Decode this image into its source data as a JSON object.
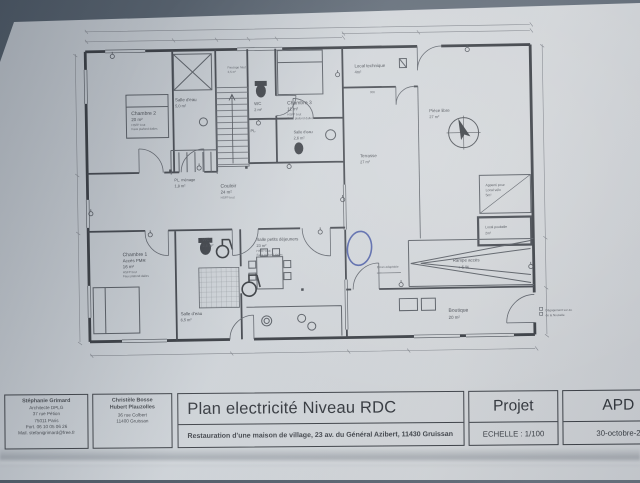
{
  "title_block": {
    "architect1": {
      "lines": [
        "Stéphanie Grimard",
        "Architecte DPLG",
        "37 rue Pétion",
        "75011 Paris",
        "Port. 06 10 05 06 26",
        "Mail. stefanigrimard@free.fr"
      ]
    },
    "architect2": {
      "lines": [
        "Christèle Bosse",
        "Hubert Plauzolles",
        "36 rue Colbert",
        "11400 Gruissan"
      ]
    },
    "title": "Plan electricité Niveau RDC",
    "subtitle": "Restauration d'une maison de village, 23 av. du Général Azibert, 11430 Gruissan",
    "phase_label": "Projet",
    "phase_value": "APD",
    "scale": "ECHELLE : 1/100",
    "date": "30-octobre-2"
  },
  "plan": {
    "rooms": {
      "chambre2": {
        "name": "Chambre 2",
        "area": "20 m²",
        "sub1": "HSFP brut",
        "sub2": "Faux plafond dalles"
      },
      "salle_eau_et2": {
        "name": "Salle d'eau",
        "area": "5,0 m²"
      },
      "wc_haut": {
        "name": "WC",
        "area": "2 m²"
      },
      "passage": {
        "name": "Passage haut",
        "area": "2,5 m²"
      },
      "chambre3": {
        "name": "Chambre 3",
        "area": "11 m²",
        "sub1": "HSFP brut",
        "sub2": "Faux plafond dalles"
      },
      "salle_eau_et3": {
        "name": "Salle d'eau",
        "area": "2,6 m²"
      },
      "pl": {
        "name": "PL."
      },
      "pl_menage": {
        "name": "PL. ménage",
        "area": "1,8 m²"
      },
      "couloir": {
        "name": "Couloir",
        "area": "24 m²",
        "sub1": "HSFP brut"
      },
      "chambre1": {
        "name": "Chambre 1",
        "sub0": "Accès PMR",
        "area": "16 m²",
        "sub1": "HSFP brut",
        "sub2": "Faux plafond dalles"
      },
      "wc_bas": {
        "name": "WC",
        "area": "2,6 m²"
      },
      "salle_eau_et1": {
        "name": "Salle d'eau",
        "area": "6,5 m²"
      },
      "petits_dejeuners": {
        "name": "Salle petits déjeuners",
        "area": "23 m²",
        "sub1": "HSFP brut",
        "sub2": "Faux plafond dalles"
      },
      "terrasse": {
        "name": "Terrasse",
        "area": "27 m²"
      },
      "piece": {
        "name": "Pièce libre",
        "area": "27 m²"
      },
      "local_technique": {
        "name": "Local technique",
        "area": "4m²"
      },
      "local_velo": {
        "line1": "Appenti pour",
        "line2": "Local vélo",
        "area": "5m²"
      },
      "local_poubelle": {
        "name": "Local poubelle",
        "area": "2m²"
      },
      "rampe": {
        "name": "Rampe accès",
        "area": "+ 5 %"
      },
      "boutique": {
        "name": "Boutique",
        "area": "20 m²"
      },
      "ecran": {
        "name": "Ecran adaptable"
      },
      "degagement": {
        "line1": "Dégagement sur av.",
        "line2": "de la Nouvelle"
      }
    },
    "dims": {
      "d1": "300"
    },
    "colors": {
      "ink": "#41454c",
      "paper": "#ced3d7",
      "pen_blue": "#3c4fa0"
    }
  }
}
